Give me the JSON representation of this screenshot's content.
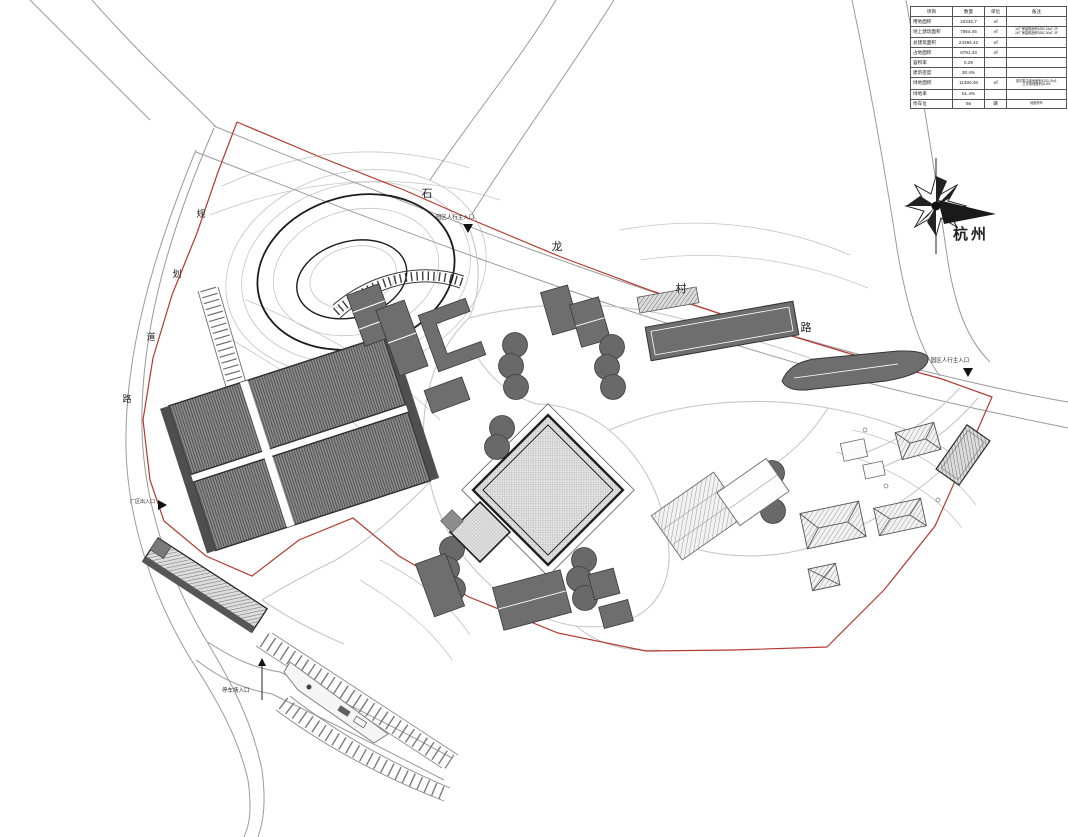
{
  "colors": {
    "boundary_red": "#b23a30",
    "building_gray": "#6e6e6e",
    "outline_dark": "#333333",
    "road_gray": "#9a9a9a",
    "contour_gray": "#c4c4c4"
  },
  "table": {
    "headers": [
      "项目",
      "数量",
      "单位",
      "备注"
    ],
    "rows": [
      {
        "item": "用地面积",
        "qty": "22332.7",
        "unit": "㎡",
        "note1": "",
        "note2": ""
      },
      {
        "item": "地上建筑面积",
        "qty": "7564.45",
        "unit": "㎡",
        "note1": "1#厂房建筑面积4282.15㎡, 2F",
        "note2": "2#厂房建筑面积3282.30㎡, 3F"
      },
      {
        "item": "总建筑面积",
        "qty": "24394.42",
        "unit": "㎡",
        "note1": "",
        "note2": ""
      },
      {
        "item": "占地面积",
        "qty": "6791.33",
        "unit": "㎡",
        "note1": "",
        "note2": ""
      },
      {
        "item": "容积率",
        "qty": "0.29",
        "unit": "",
        "note1": "",
        "note2": ""
      },
      {
        "item": "建筑密度",
        "qty": "30.4%",
        "unit": "",
        "note1": "",
        "note2": ""
      },
      {
        "item": "绿地面积",
        "qty": "11480.46",
        "unit": "㎡",
        "note1": "其中集中绿地面积4203.15㎡,",
        "note2": "占总用地面积18.8%"
      },
      {
        "item": "绿地率",
        "qty": "51.4%",
        "unit": "",
        "note1": "",
        "note2": ""
      },
      {
        "item": "停车位",
        "qty": "56",
        "unit": "辆",
        "note1": "地面停车",
        "note2": ""
      }
    ]
  },
  "labels": {
    "main_road": {
      "name": "石龙村路",
      "chars": [
        "石",
        "龙",
        "村",
        "路"
      ]
    },
    "side_road": {
      "name": "规划道路",
      "chars": [
        "规",
        "划",
        "道",
        "路"
      ]
    },
    "entrance_north": "园区人行主入口",
    "entrance_east": "园区人行主入口",
    "entrance_west": "厂区出入口",
    "entrance_parking": "停车场入口",
    "compass_city": "杭州"
  }
}
